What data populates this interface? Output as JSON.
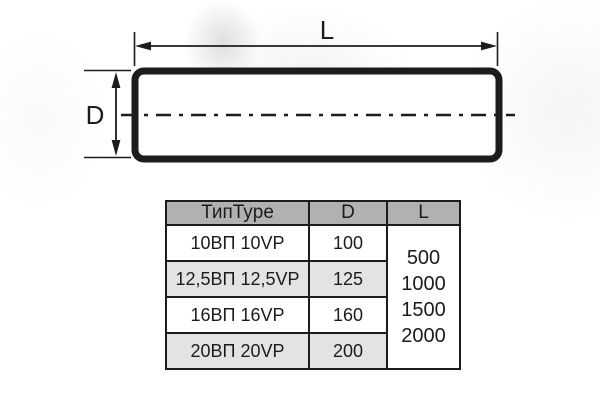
{
  "diagram": {
    "length_label": "L",
    "diameter_label": "D",
    "stroke_color": "#1c1c1c"
  },
  "table": {
    "columns": {
      "type": "ТипType",
      "d": "D",
      "l": "L"
    },
    "rows": [
      {
        "type": "10ВП 10VP",
        "d": "100"
      },
      {
        "type": "12,5ВП 12,5VP",
        "d": "125"
      },
      {
        "type": "16ВП 16VP",
        "d": "160"
      },
      {
        "type": "20ВП 20VP",
        "d": "200"
      }
    ],
    "l_values": [
      "500",
      "1000",
      "1500",
      "2000"
    ],
    "colors": {
      "header_bg": "#b1b1b1",
      "alt_row_bg": "#e3e3e3",
      "border": "#1c1c1c",
      "text": "#1c1c1c"
    }
  }
}
